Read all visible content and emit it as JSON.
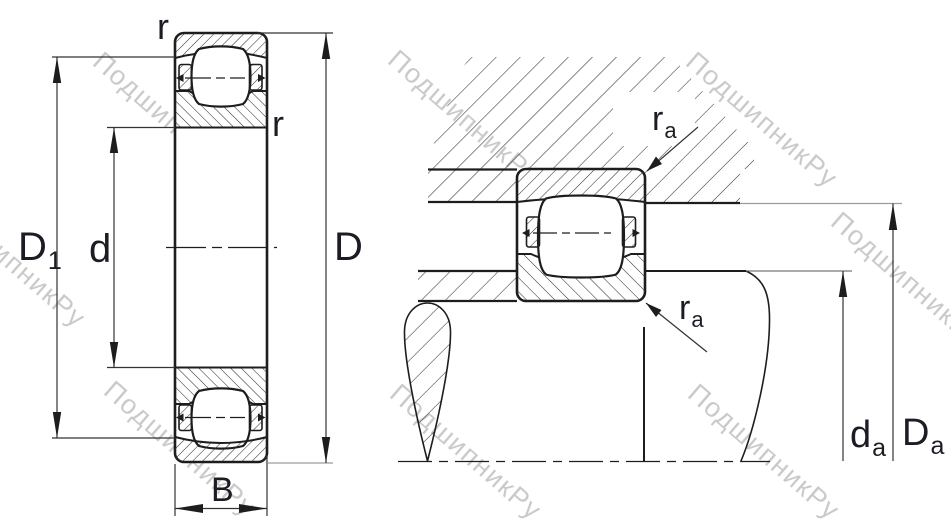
{
  "drawing": {
    "kind": "bearing engineering drawing, two cross-section views",
    "watermark": {
      "text": "ПодшипникРу"
    },
    "left_view": {
      "description": "bearing front cross-section with boundary dimensions",
      "labels": {
        "r_top": "r",
        "r_inner": "r",
        "d1_main": "D",
        "d1_sub": "1",
        "bore": "d",
        "outer": "D",
        "width": "B"
      }
    },
    "right_view": {
      "description": "bearing mounted in housing on shaft with abutment dimensions",
      "labels": {
        "ra_top_main": "r",
        "ra_top_sub": "a",
        "ra_bottom_main": "r",
        "ra_bottom_sub": "a",
        "da_main": "d",
        "da_sub": "a",
        "Da_main": "D",
        "Da_sub": "a"
      }
    },
    "colors": {
      "line": "#1d1d1d",
      "dim_line": "#333333",
      "gray_extension": "#9c9c9c",
      "watermark": "#c5c5c5"
    }
  }
}
